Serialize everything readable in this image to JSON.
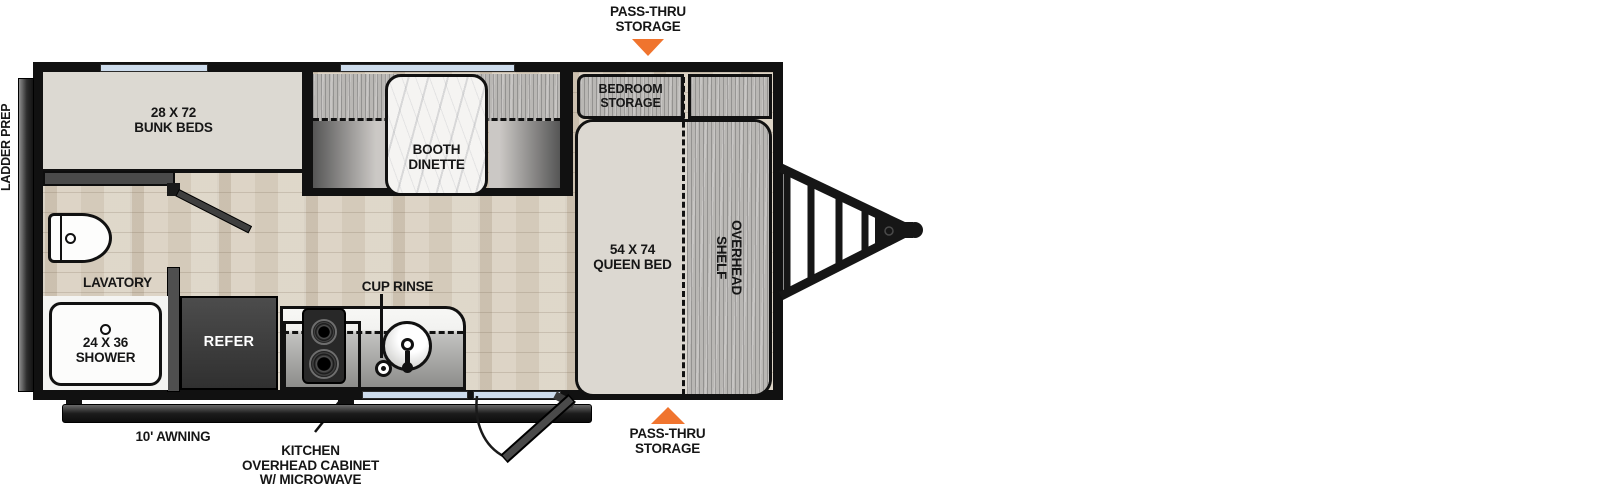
{
  "callouts": {
    "pass_thru_top": [
      "PASS-THRU",
      "STORAGE"
    ],
    "pass_thru_bottom": [
      "PASS-THRU",
      "STORAGE"
    ],
    "ladder_prep": "LADDER PREP",
    "awning": "10' AWNING",
    "kitchen_ohc": [
      "KITCHEN",
      "OVERHEAD CABINET",
      "W/ MICROWAVE"
    ],
    "cup_rinse": "CUP RINSE"
  },
  "rooms": {
    "bunk_beds": [
      "28 X 72",
      "BUNK BEDS"
    ],
    "ohc": "OHC",
    "booth_dinette": [
      "BOOTH",
      "DINETTE"
    ],
    "bedroom_storage": [
      "BEDROOM",
      "STORAGE"
    ],
    "queen_bed": [
      "54 X 74",
      "QUEEN BED"
    ],
    "overhead_shelf": [
      "OVERHEAD",
      "SHELF"
    ],
    "lavatory": "LAVATORY",
    "shower": [
      "24 X 36",
      "SHOWER"
    ],
    "refer": "REFER"
  },
  "colors": {
    "accent_orange": "#F0742E",
    "wall_black": "#111111",
    "window_blue": "#CDDCEC"
  }
}
